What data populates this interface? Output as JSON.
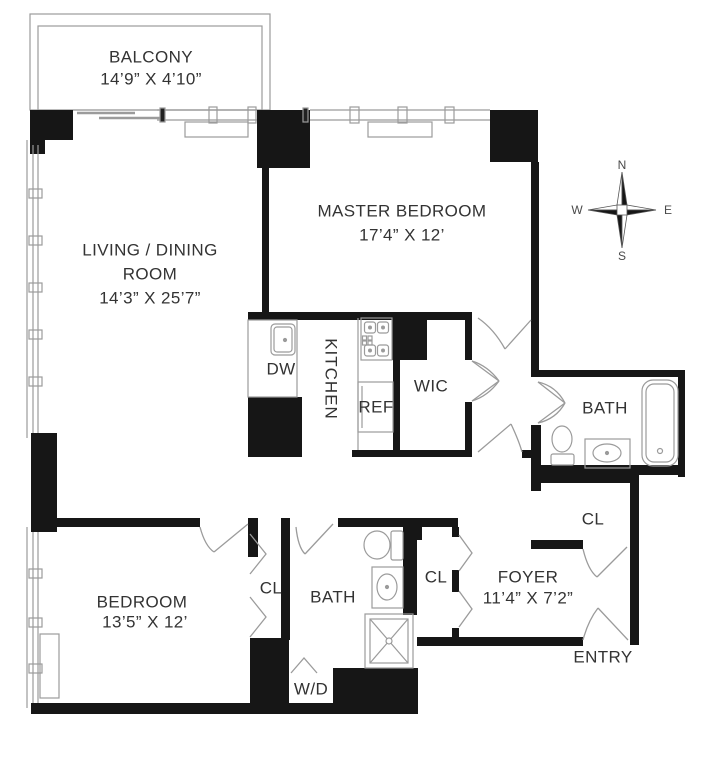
{
  "plan": {
    "colors": {
      "wall": "#161616",
      "thin_line": "#9b9b9b",
      "text": "#333333"
    },
    "rooms": {
      "balcony": {
        "name": "BALCONY",
        "dims": "14’9” X 4’10”"
      },
      "living": {
        "name_line1": "LIVING / DINING",
        "name_line2": "ROOM",
        "dims": "14’3” X 25’7”"
      },
      "master_bedroom": {
        "name": "MASTER BEDROOM",
        "dims": "17’4” X 12’"
      },
      "bedroom": {
        "name": "BEDROOM",
        "dims": "13’5” X 12’"
      },
      "foyer": {
        "name": "FOYER",
        "dims": "11’4” X 7’2”"
      },
      "kitchen": {
        "name": "KITCHEN"
      },
      "wic": {
        "name": "WIC"
      },
      "master_bath": {
        "name": "BATH"
      },
      "bath": {
        "name": "BATH"
      }
    },
    "fixtures": {
      "dishwasher": "DW",
      "refrigerator": "REF",
      "washer_dryer": "W/D"
    },
    "closets": {
      "bedroom_closet": "CL",
      "hall_closet": "CL",
      "foyer_closet": "CL"
    },
    "entry_label": "ENTRY",
    "compass": {
      "north": "N",
      "south": "S",
      "east": "E",
      "west": "W"
    }
  }
}
